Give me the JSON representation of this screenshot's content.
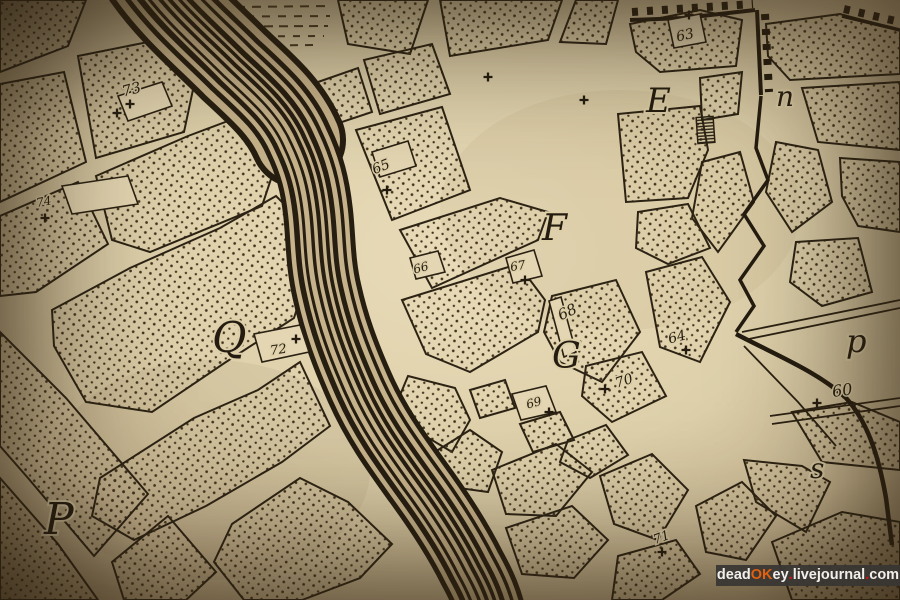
{
  "meta": {
    "description": "Photograph of an antique engraved city plan with a river, stippled blocks, fortification walls and index letters/numbers",
    "paper_color": "#dccfa9",
    "ink_color": "#241c10",
    "river_line_color": "#261e11",
    "river_fill_color": "#c7b38b"
  },
  "letters": {
    "Q": "Q",
    "P": "P",
    "F": "F",
    "G": "G",
    "E": "E",
    "n_lower": "n",
    "p_lower": "p",
    "s_lower": "s"
  },
  "numbers": {
    "n60": "60",
    "n63": "63",
    "n64": "64",
    "n65": "65",
    "n66": "66",
    "n67": "67",
    "n68": "68",
    "n69": "69",
    "n70": "70",
    "n71": "71",
    "n72": "72",
    "n73": "73",
    "n74": "74"
  },
  "watermark": {
    "bg": "#383634",
    "segments": [
      {
        "text": "dead",
        "color": "#f1efec"
      },
      {
        "text": "OK",
        "color": "#e2600f"
      },
      {
        "text": "ey",
        "color": "#f1efec"
      },
      {
        "text": ".",
        "color": "#d61313"
      },
      {
        "text": "livejournal",
        "color": "#f1efec"
      },
      {
        "text": ".",
        "color": "#d61313"
      },
      {
        "text": "com",
        "color": "#f1efec"
      }
    ]
  }
}
